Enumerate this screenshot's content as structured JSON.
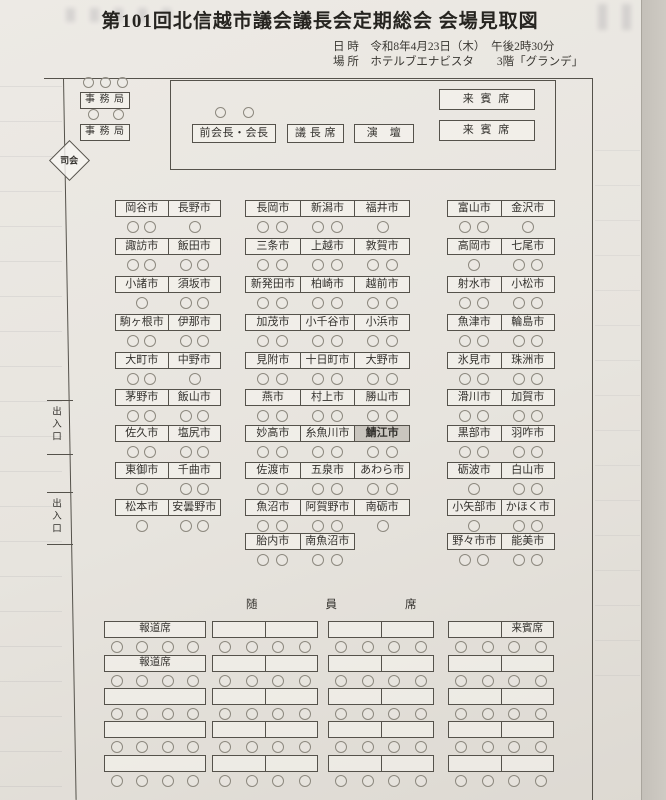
{
  "title": "第101回北信越市議会議長会定期総会 会場見取図",
  "meta": {
    "datetime_line": "日 時　令和8年4月23日（木）　午後2時30分",
    "place_line": "場 所　ホテルブエナビスタ　　3階「グランデ」"
  },
  "stage": {
    "secretariat": [
      {
        "label": "事 務 局",
        "seats_above": 3
      },
      {
        "label": "事 務 局",
        "seats_above": 2
      }
    ],
    "mc_label": "司会",
    "head_tables": [
      {
        "label": "前会長・会長",
        "seats_above": 2
      },
      {
        "label": "議 長 席",
        "seats_above": 0
      },
      {
        "label": "演　壇",
        "seats_above": 0
      }
    ],
    "guest_boxes": [
      {
        "label": "来 賓 席"
      },
      {
        "label": "来 賓 席"
      }
    ]
  },
  "doors": {
    "label": "出入口",
    "count": 2
  },
  "seating": {
    "columns": [
      {
        "id": "left",
        "rows": [
          {
            "cells": [
              {
                "name": "岡谷市",
                "seats": 2
              },
              {
                "name": "長野市",
                "seats": 1
              }
            ]
          },
          {
            "cells": [
              {
                "name": "諏訪市",
                "seats": 2
              },
              {
                "name": "飯田市",
                "seats": 2
              }
            ]
          },
          {
            "cells": [
              {
                "name": "小諸市",
                "seats": 1
              },
              {
                "name": "須坂市",
                "seats": 2
              }
            ]
          },
          {
            "cells": [
              {
                "name": "駒ヶ根市",
                "seats": 2
              },
              {
                "name": "伊那市",
                "seats": 2
              }
            ]
          },
          {
            "cells": [
              {
                "name": "大町市",
                "seats": 2
              },
              {
                "name": "中野市",
                "seats": 1
              }
            ]
          },
          {
            "cells": [
              {
                "name": "茅野市",
                "seats": 2
              },
              {
                "name": "飯山市",
                "seats": 2
              }
            ]
          },
          {
            "cells": [
              {
                "name": "佐久市",
                "seats": 2
              },
              {
                "name": "塩尻市",
                "seats": 2
              }
            ]
          },
          {
            "cells": [
              {
                "name": "東御市",
                "seats": 1
              },
              {
                "name": "千曲市",
                "seats": 2
              }
            ]
          },
          {
            "cells": [
              {
                "name": "松本市",
                "seats": 1
              },
              {
                "name": "安曇野市",
                "seats": 2
              }
            ]
          }
        ]
      },
      {
        "id": "middle",
        "rows": [
          {
            "cells": [
              {
                "name": "長岡市",
                "seats": 2
              },
              {
                "name": "新潟市",
                "seats": 2
              },
              {
                "name": "福井市",
                "seats": 1
              }
            ]
          },
          {
            "cells": [
              {
                "name": "三条市",
                "seats": 2
              },
              {
                "name": "上越市",
                "seats": 2
              },
              {
                "name": "敦賀市",
                "seats": 2
              }
            ]
          },
          {
            "cells": [
              {
                "name": "新発田市",
                "seats": 2
              },
              {
                "name": "柏崎市",
                "seats": 2
              },
              {
                "name": "越前市",
                "seats": 2
              }
            ]
          },
          {
            "cells": [
              {
                "name": "加茂市",
                "seats": 2
              },
              {
                "name": "小千谷市",
                "seats": 2
              },
              {
                "name": "小浜市",
                "seats": 2
              }
            ]
          },
          {
            "cells": [
              {
                "name": "見附市",
                "seats": 2
              },
              {
                "name": "十日町市",
                "seats": 2
              },
              {
                "name": "大野市",
                "seats": 2
              }
            ]
          },
          {
            "cells": [
              {
                "name": "燕市",
                "seats": 2
              },
              {
                "name": "村上市",
                "seats": 2
              },
              {
                "name": "勝山市",
                "seats": 2
              }
            ]
          },
          {
            "cells": [
              {
                "name": "妙高市",
                "seats": 2
              },
              {
                "name": "糸魚川市",
                "seats": 2
              },
              {
                "name": "鯖江市",
                "seats": 2,
                "highlight": true
              }
            ]
          },
          {
            "cells": [
              {
                "name": "佐渡市",
                "seats": 2
              },
              {
                "name": "五泉市",
                "seats": 2
              },
              {
                "name": "あわら市",
                "seats": 2
              }
            ]
          },
          {
            "cells": [
              {
                "name": "魚沼市",
                "seats": 2
              },
              {
                "name": "阿賀野市",
                "seats": 2
              },
              {
                "name": "南砺市",
                "seats": 1
              }
            ]
          },
          {
            "cells": [
              {
                "name": "胎内市",
                "seats": 2
              },
              {
                "name": "南魚沼市",
                "seats": 2
              }
            ]
          }
        ]
      },
      {
        "id": "right",
        "rows": [
          {
            "cells": [
              {
                "name": "富山市",
                "seats": 2
              },
              {
                "name": "金沢市",
                "seats": 1
              }
            ]
          },
          {
            "cells": [
              {
                "name": "高岡市",
                "seats": 1
              },
              {
                "name": "七尾市",
                "seats": 2
              }
            ]
          },
          {
            "cells": [
              {
                "name": "射水市",
                "seats": 2
              },
              {
                "name": "小松市",
                "seats": 2
              }
            ]
          },
          {
            "cells": [
              {
                "name": "魚津市",
                "seats": 2
              },
              {
                "name": "輪島市",
                "seats": 2
              }
            ]
          },
          {
            "cells": [
              {
                "name": "氷見市",
                "seats": 2
              },
              {
                "name": "珠洲市",
                "seats": 2
              }
            ]
          },
          {
            "cells": [
              {
                "name": "滑川市",
                "seats": 2
              },
              {
                "name": "加賀市",
                "seats": 2
              }
            ]
          },
          {
            "cells": [
              {
                "name": "黒部市",
                "seats": 2
              },
              {
                "name": "羽咋市",
                "seats": 2
              }
            ]
          },
          {
            "cells": [
              {
                "name": "砺波市",
                "seats": 1
              },
              {
                "name": "白山市",
                "seats": 2
              }
            ]
          },
          {
            "cells": [
              {
                "name": "小矢部市",
                "seats": 1
              },
              {
                "name": "かほく市",
                "seats": 2
              }
            ]
          },
          {
            "cells": [
              {
                "name": "野々市市",
                "seats": 2
              },
              {
                "name": "能美市",
                "seats": 2
              }
            ]
          }
        ]
      }
    ]
  },
  "bottom": {
    "attendant_label": "随員席",
    "press_label": "報道席",
    "guest_label": "来賓席",
    "seats_per_table": 4,
    "rows": [
      {
        "tables": [
          {
            "label": "報道席"
          },
          {
            "split": true
          },
          {
            "split": true
          },
          {
            "split": true,
            "right_label": "来賓席"
          }
        ]
      },
      {
        "tables": [
          {
            "label": "報道席"
          },
          {
            "split": true
          },
          {
            "split": true
          },
          {
            "split": true
          }
        ]
      },
      {
        "tables": [
          {},
          {
            "split": true
          },
          {
            "split": true
          },
          {
            "split": true
          }
        ]
      },
      {
        "tables": [
          {},
          {
            "split": true
          },
          {
            "split": true
          },
          {
            "split": true
          }
        ]
      },
      {
        "tables": [
          {},
          {
            "split": true
          },
          {
            "split": true
          },
          {
            "split": true
          }
        ]
      }
    ]
  },
  "colors": {
    "paper": "#e9e6e0",
    "line": "#55524b",
    "circle_outline": "#8d897f",
    "highlight_bg": "#c9c5be",
    "text": "#33312d"
  }
}
